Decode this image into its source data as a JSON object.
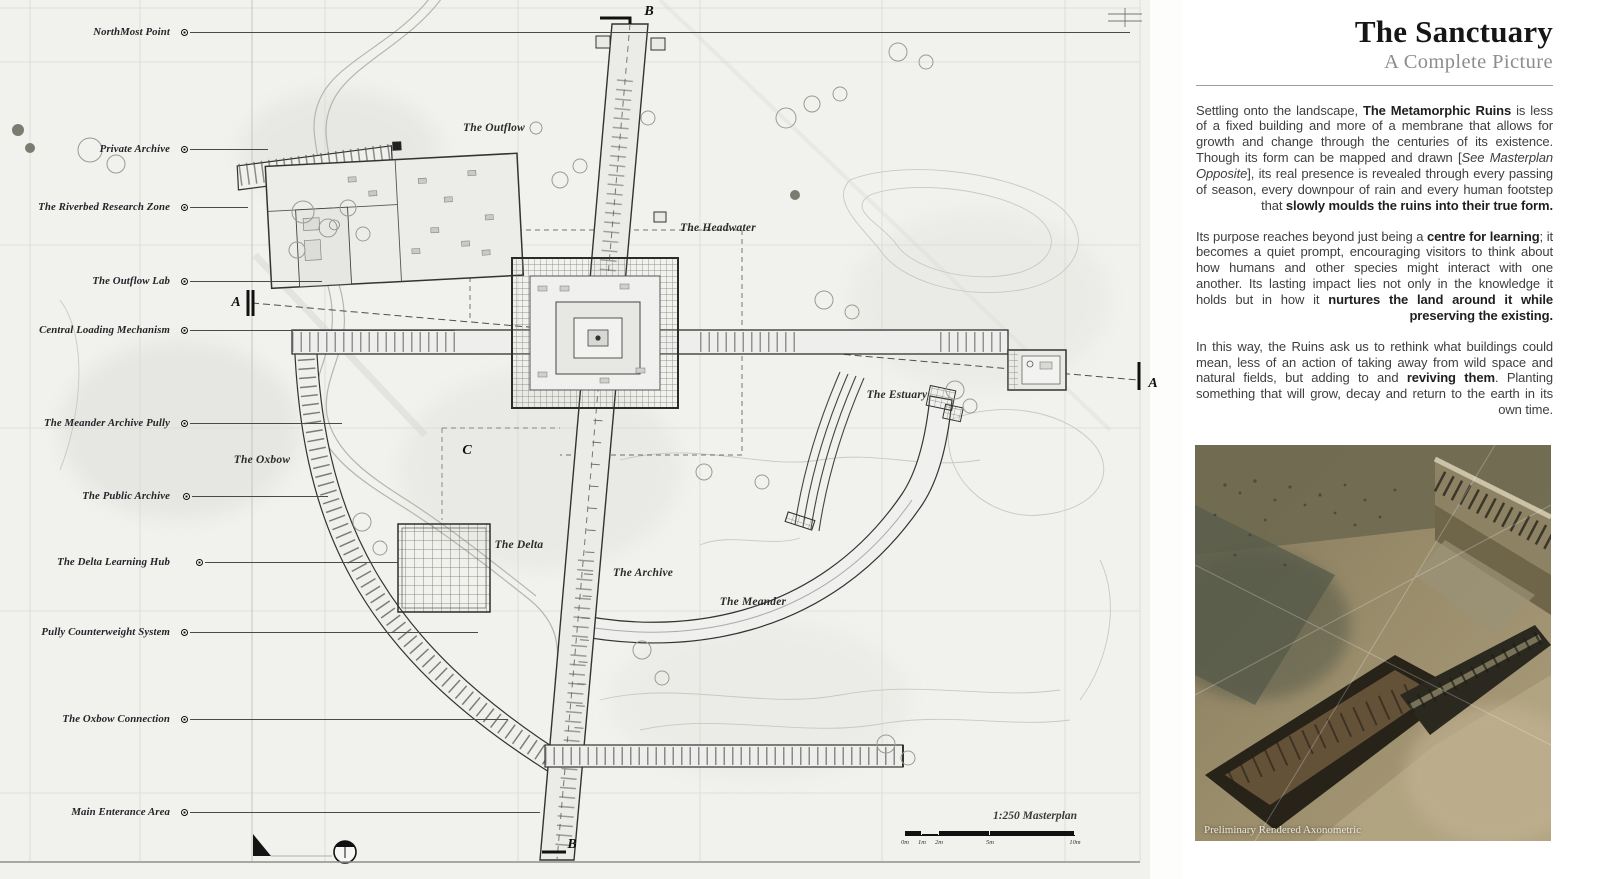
{
  "colors": {
    "paper": "#f1f1ee",
    "panel_bg": "#ffffff",
    "ink": "#2f2f2d",
    "leader": "#4a4a4a"
  },
  "panel": {
    "title": "The Sanctuary",
    "subtitle": "A Complete Picture",
    "paragraphs": [
      {
        "segments": [
          {
            "t": "Settling onto the landscape, "
          },
          {
            "t": "The Metamorphic Ruins",
            "b": true
          },
          {
            "t": " is less of a fixed building and more of a membrane that allows for growth and change through the centuries of its existence. Though its form can be mapped and drawn ["
          },
          {
            "t": "See Masterplan Opposite",
            "i": true
          },
          {
            "t": "], its real presence is revealed through every passing of season, every downpour of rain and every human footstep that "
          },
          {
            "t": "slowly moulds the ruins into their true form.",
            "b": true
          }
        ]
      },
      {
        "segments": [
          {
            "t": "Its purpose reaches beyond just being a "
          },
          {
            "t": "centre for learning",
            "b": true
          },
          {
            "t": "; it becomes a quiet prompt, encouraging visitors to think about how humans and other species might interact with one another. Its lasting impact lies not only in the knowledge it holds but in how it "
          },
          {
            "t": "nurtures the land around it while preserving the existing.",
            "b": true
          }
        ]
      },
      {
        "segments": [
          {
            "t": "In this way, the Ruins ask us to rethink what buildings could mean, less of an action of taking away from wild space and natural fields, but adding to and "
          },
          {
            "t": "reviving them",
            "b": true
          },
          {
            "t": ". Planting something that will grow, decay and return to the earth in its own time."
          }
        ]
      }
    ],
    "image_caption": "Preliminary Rendered Axonometric"
  },
  "map": {
    "key_labels": [
      {
        "label": "NorthMost Point",
        "y": 33,
        "dot_x": 184,
        "line_end": 1130
      },
      {
        "label": "Private Archive",
        "y": 150,
        "dot_x": 184,
        "line_end": 268
      },
      {
        "label": "The Riverbed Research Zone",
        "y": 208,
        "dot_x": 184,
        "line_end": 248
      },
      {
        "label": "The Outflow Lab",
        "y": 282,
        "dot_x": 184,
        "line_end": 322
      },
      {
        "label": "Central Loading Mechanism",
        "y": 331,
        "dot_x": 184,
        "line_end": 455
      },
      {
        "label": "The Meander Archive Pully",
        "y": 424,
        "dot_x": 184,
        "line_end": 342
      },
      {
        "label": "The Public Archive",
        "y": 497,
        "dot_x": 186,
        "line_end": 328
      },
      {
        "label": "The Delta Learning Hub",
        "y": 563,
        "dot_x": 199,
        "line_end": 398
      },
      {
        "label": "Pully Counterweight System",
        "y": 633,
        "dot_x": 184,
        "line_end": 478
      },
      {
        "label": "The Oxbow Connection",
        "y": 720,
        "dot_x": 184,
        "line_end": 508
      },
      {
        "label": "Main Enterance Area",
        "y": 813,
        "dot_x": 184,
        "line_end": 540
      }
    ],
    "map_labels": [
      {
        "label": "The Outflow",
        "x": 494,
        "y": 128
      },
      {
        "label": "The Headwater",
        "x": 718,
        "y": 228
      },
      {
        "label": "The Estuary",
        "x": 897,
        "y": 395
      },
      {
        "label": "The Oxbow",
        "x": 262,
        "y": 460
      },
      {
        "label": "The Delta",
        "x": 519,
        "y": 545
      },
      {
        "label": "The Archive",
        "x": 643,
        "y": 573
      },
      {
        "label": "The Meander",
        "x": 753,
        "y": 602
      }
    ],
    "section_markers": [
      {
        "letter": "B",
        "x": 649,
        "y": 12
      },
      {
        "letter": "B",
        "x": 572,
        "y": 845
      },
      {
        "letter": "A",
        "x": 236,
        "y": 303
      },
      {
        "letter": "A",
        "x": 1153,
        "y": 384
      },
      {
        "letter": "C",
        "x": 467,
        "y": 451
      }
    ],
    "scale": {
      "label": "1:250 Masterplan",
      "ticks": [
        {
          "t": "0m",
          "x": 0
        },
        {
          "t": "1m",
          "x": 17
        },
        {
          "t": "2m",
          "x": 34
        },
        {
          "t": "5m",
          "x": 85
        },
        {
          "t": "10m",
          "x": 170
        }
      ]
    }
  }
}
